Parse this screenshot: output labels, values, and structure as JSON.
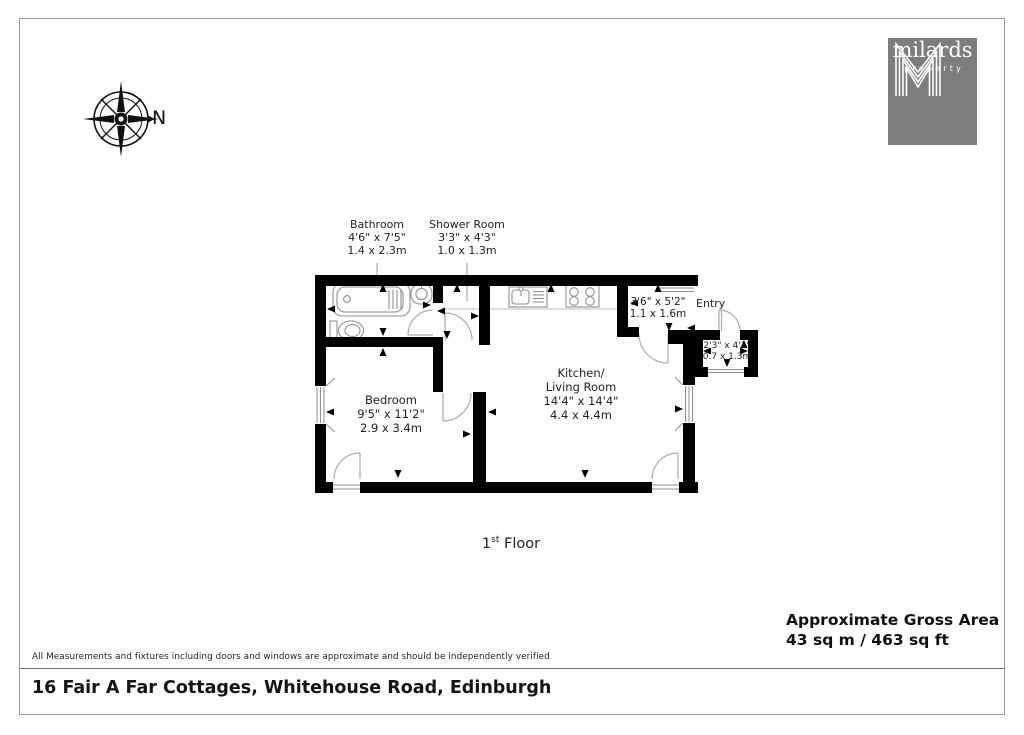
{
  "compass": {
    "label": "N"
  },
  "logo": {
    "monogram": "M",
    "name": "milards",
    "tagline": "property"
  },
  "plan": {
    "bathroom": {
      "name": "Bathroom",
      "imperial": "4'6\" x 7'5\"",
      "metric": "1.4 x 2.3m"
    },
    "shower_room": {
      "name": "Shower Room",
      "imperial": "3'3\" x 4'3\"",
      "metric": "1.0 x 1.3m"
    },
    "hallway": {
      "imperial": "3'6\" x 5'2\"",
      "metric": "1.1 x 1.6m"
    },
    "entry": {
      "name": "Entry",
      "imperial": "2'3\" x 4'3\"",
      "metric": "0.7 x 1.3m"
    },
    "kitchen_living": {
      "name_line1": "Kitchen/",
      "name_line2": "Living Room",
      "imperial": "14'4\" x 14'4\"",
      "metric": "4.4 x 4.4m"
    },
    "bedroom": {
      "name": "Bedroom",
      "imperial": "9'5\" x 11'2\"",
      "metric": "2.9 x 3.4m"
    }
  },
  "floor": {
    "number": "1",
    "ordinal": "st",
    "label": " Floor"
  },
  "gross_area": {
    "title": "Approximate Gross Area",
    "value": "43 sq m / 463 sq ft"
  },
  "footer": {
    "disclaimer": "All Measurements and fixtures including doors and windows are approximate and should be independently verified",
    "address": "16 Fair A Far Cottages, Whitehouse Road, Edinburgh"
  }
}
